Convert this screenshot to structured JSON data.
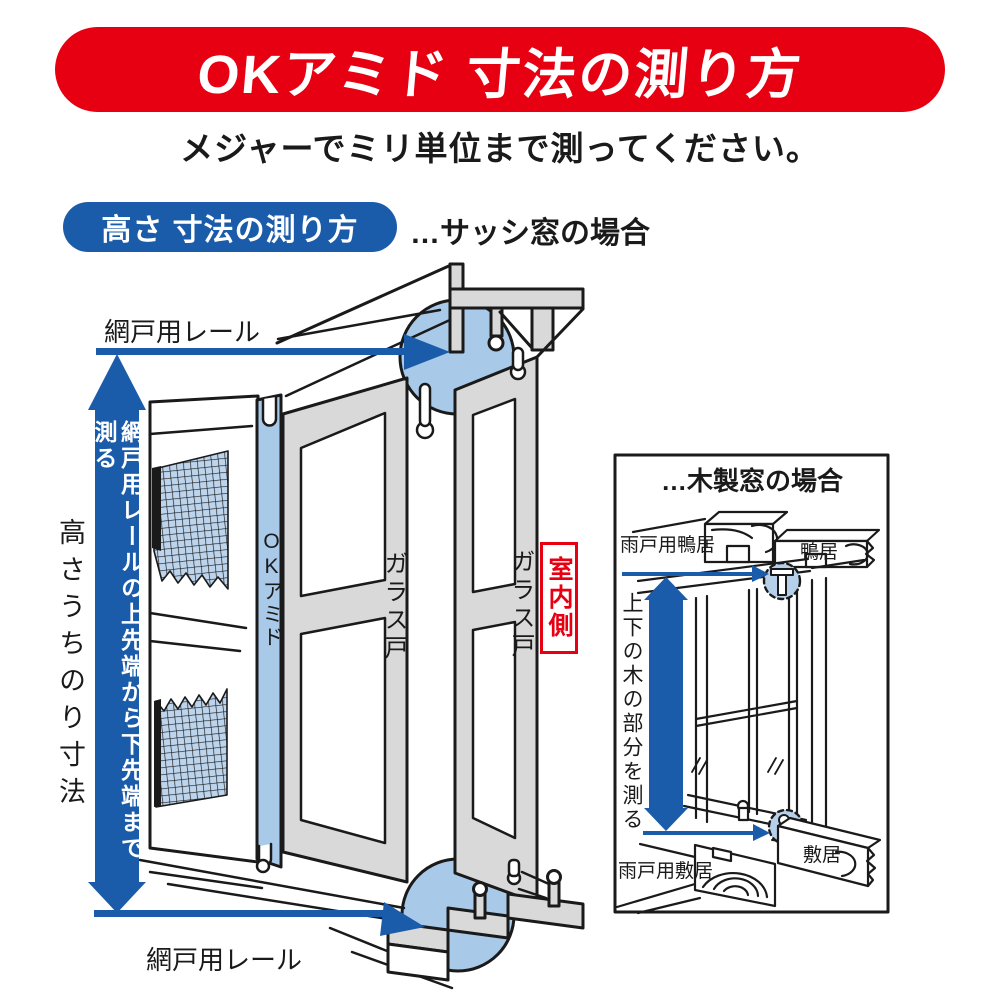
{
  "header": {
    "title": "OKアミド 寸法の測り方",
    "subtitle": "メジャーでミリ単位まで測ってください。"
  },
  "section": {
    "badge_label": "高さ 寸法の測り方",
    "case_note": "…サッシ窓の場合"
  },
  "sash_diagram": {
    "rail_label": "網戸用レール",
    "measure_arrow_label": "網戸用レールの上先端から下先端まで測る",
    "inner_height_label": "高さうちのり寸法",
    "screen_label": "OKアミド",
    "glass_door_label": "ガラス戸",
    "indoor_side_label": "室内側"
  },
  "wooden_diagram": {
    "title": "…木製窓の場合",
    "amado_kamoi_label": "雨戸用鴨居",
    "kamoi_label": "鴨居",
    "measure_label": "上下の木の部分を測る",
    "amado_shikii_label": "雨戸用敷居",
    "shikii_label": "敷居"
  },
  "colors": {
    "brand_red": "#e60012",
    "accent_blue": "#1b5caa",
    "highlight_blue": "#a9c9e9",
    "panel_gray": "#d9d9d9"
  }
}
